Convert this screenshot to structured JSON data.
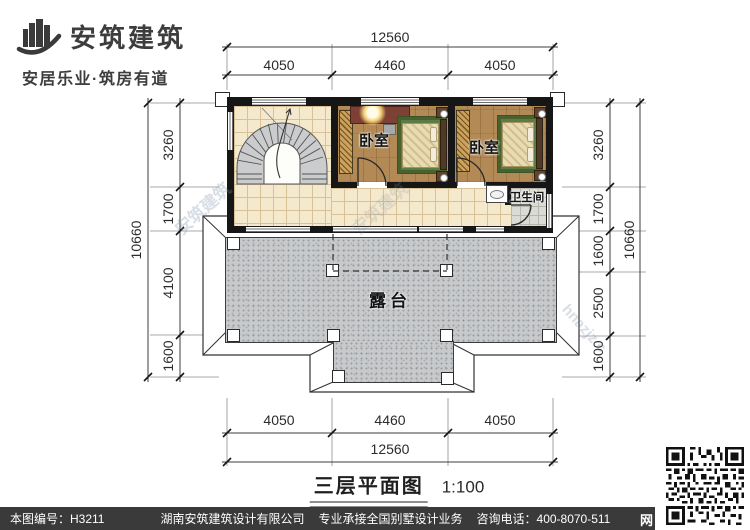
{
  "logo": {
    "name": "安筑建筑",
    "tagline": "安居乐业·筑房有道"
  },
  "plan": {
    "rooms": {
      "bedroom1": "卧室",
      "bedroom2": "卧室",
      "bathroom": "卫生间",
      "terrace": "露台"
    },
    "dimensions": {
      "top": {
        "total": "12560",
        "segments": [
          "4050",
          "4460",
          "4050"
        ]
      },
      "bottom": {
        "total": "12560",
        "segments": [
          "4050",
          "4460",
          "4050"
        ]
      },
      "left": {
        "total": "10660",
        "segments": [
          "3260",
          "1700",
          "4100",
          "1600"
        ]
      },
      "right": {
        "total": "10660",
        "segments": [
          "3260",
          "1700",
          "1600",
          "2500",
          "1600"
        ]
      }
    }
  },
  "title": {
    "text": "三层平面图",
    "scale": "1:100"
  },
  "watermark": {
    "brand": "安筑建筑",
    "code": "hnazjz.c"
  },
  "footer": {
    "drawing_no": "本图编号：H3211",
    "company": "湖南安筑建筑设计有限公司",
    "service": "专业承接全国别墅设计业务",
    "phone": "咨询电话：400-8070-511",
    "web": "网"
  },
  "colors": {
    "wall": "#161616",
    "wood": "#b38a55",
    "woodLine": "#9c7644",
    "tile": "#f4e9cc",
    "tileLine": "#d8c197",
    "terrace": "#c7c9cb",
    "rug": "#5d7b45",
    "mattress": "#e9dcb2",
    "footerBg": "#3a3a3a"
  }
}
